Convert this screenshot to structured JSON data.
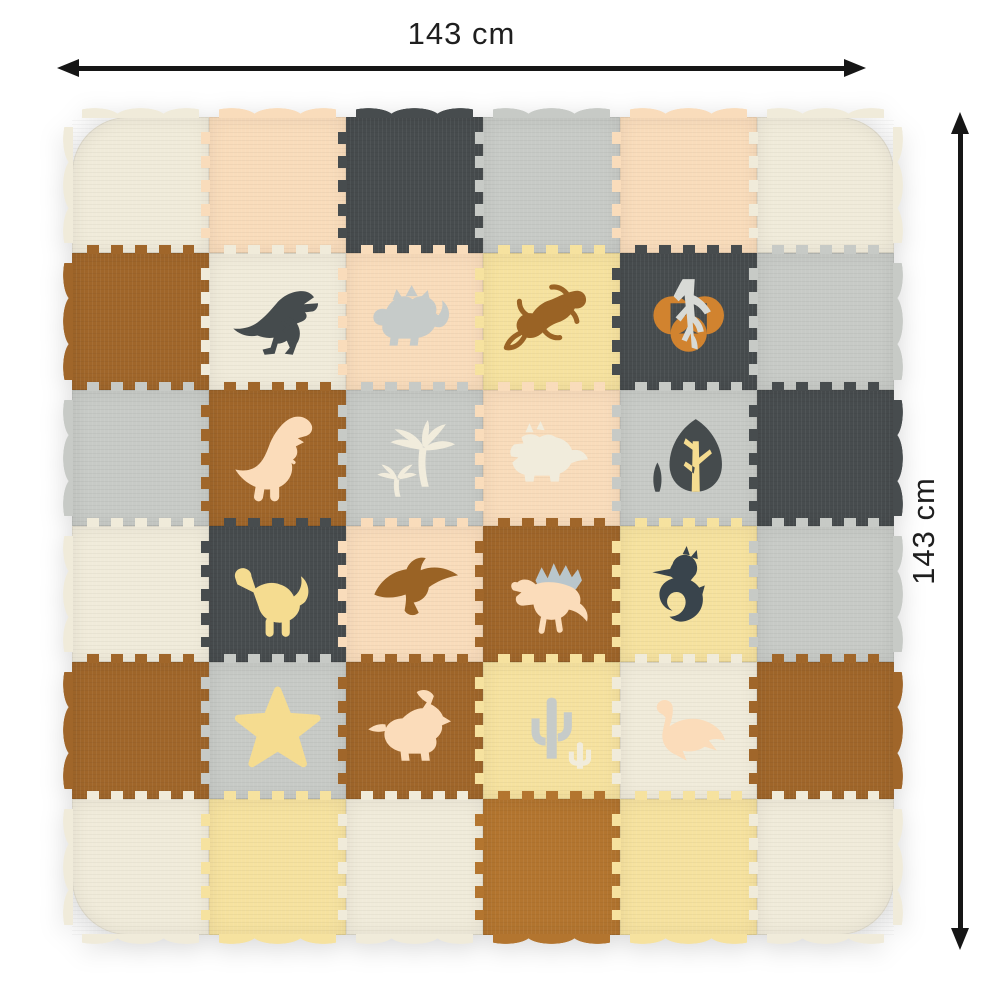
{
  "dimensions": {
    "width_label": "143 cm",
    "height_label": "143 cm",
    "arrow_color": "#161616",
    "label_color": "#1f1f1f"
  },
  "mat": {
    "rows": 6,
    "cols": 6,
    "palette": {
      "cream": "#f0ebda",
      "peach": "#f9dcbb",
      "dark": "#474c4e",
      "gray": "#c7cac6",
      "brown": "#a0662a",
      "caramel": "#b3752f",
      "yellow": "#f6e29f",
      "m_dark": "#454b4d",
      "m_gray": "#c6cbc9",
      "m_cream": "#f1ecdc",
      "m_peach": "#fbdcba",
      "m_yellow": "#f5dc90",
      "m_brown": "#9a6325",
      "orange": "#d1832f",
      "root_gray": "#d8dad6",
      "navy": "#39444c",
      "sail": "#b9c6cc"
    },
    "tiles": [
      {
        "r": 0,
        "c": 0,
        "bg": "cream"
      },
      {
        "r": 0,
        "c": 1,
        "bg": "peach"
      },
      {
        "r": 0,
        "c": 2,
        "bg": "dark"
      },
      {
        "r": 0,
        "c": 3,
        "bg": "gray"
      },
      {
        "r": 0,
        "c": 4,
        "bg": "peach"
      },
      {
        "r": 0,
        "c": 5,
        "bg": "cream"
      },
      {
        "r": 1,
        "c": 0,
        "bg": "brown"
      },
      {
        "r": 1,
        "c": 1,
        "bg": "cream",
        "motif": "trex",
        "colors": [
          "m_dark"
        ]
      },
      {
        "r": 1,
        "c": 2,
        "bg": "peach",
        "motif": "stegosaurus",
        "colors": [
          "m_gray"
        ]
      },
      {
        "r": 1,
        "c": 3,
        "bg": "yellow",
        "motif": "gecko",
        "colors": [
          "m_brown"
        ]
      },
      {
        "r": 1,
        "c": 4,
        "bg": "dark",
        "motif": "tree_roots",
        "colors": [
          "orange",
          "root_gray"
        ]
      },
      {
        "r": 1,
        "c": 5,
        "bg": "gray"
      },
      {
        "r": 2,
        "c": 0,
        "bg": "gray"
      },
      {
        "r": 2,
        "c": 1,
        "bg": "brown",
        "motif": "trex_big",
        "colors": [
          "m_peach"
        ]
      },
      {
        "r": 2,
        "c": 2,
        "bg": "gray",
        "motif": "palms",
        "colors": [
          "m_cream"
        ]
      },
      {
        "r": 2,
        "c": 3,
        "bg": "peach",
        "motif": "triceratops",
        "colors": [
          "m_cream"
        ]
      },
      {
        "r": 2,
        "c": 4,
        "bg": "gray",
        "motif": "tree",
        "colors": [
          "m_dark",
          "m_yellow",
          "m_dark"
        ]
      },
      {
        "r": 2,
        "c": 5,
        "bg": "dark"
      },
      {
        "r": 3,
        "c": 0,
        "bg": "cream"
      },
      {
        "r": 3,
        "c": 1,
        "bg": "dark",
        "motif": "brachiosaurus",
        "colors": [
          "m_yellow"
        ]
      },
      {
        "r": 3,
        "c": 2,
        "bg": "peach",
        "motif": "pterodactyl",
        "colors": [
          "m_brown"
        ]
      },
      {
        "r": 3,
        "c": 3,
        "bg": "brown",
        "motif": "spinosaurus",
        "colors": [
          "sail",
          "m_peach"
        ]
      },
      {
        "r": 3,
        "c": 4,
        "bg": "yellow",
        "motif": "seahorse",
        "colors": [
          "navy"
        ]
      },
      {
        "r": 3,
        "c": 5,
        "bg": "gray"
      },
      {
        "r": 4,
        "c": 0,
        "bg": "brown"
      },
      {
        "r": 4,
        "c": 1,
        "bg": "gray",
        "motif": "star",
        "colors": [
          "m_yellow"
        ]
      },
      {
        "r": 4,
        "c": 2,
        "bg": "brown",
        "motif": "parasaurolophus",
        "colors": [
          "m_peach"
        ]
      },
      {
        "r": 4,
        "c": 3,
        "bg": "yellow",
        "motif": "cactus",
        "colors": [
          "m_gray",
          "m_cream"
        ]
      },
      {
        "r": 4,
        "c": 4,
        "bg": "cream",
        "motif": "plesiosaur",
        "colors": [
          "m_peach"
        ]
      },
      {
        "r": 4,
        "c": 5,
        "bg": "brown"
      },
      {
        "r": 5,
        "c": 0,
        "bg": "cream"
      },
      {
        "r": 5,
        "c": 1,
        "bg": "yellow"
      },
      {
        "r": 5,
        "c": 2,
        "bg": "cream"
      },
      {
        "r": 5,
        "c": 3,
        "bg": "caramel"
      },
      {
        "r": 5,
        "c": 4,
        "bg": "yellow"
      },
      {
        "r": 5,
        "c": 5,
        "bg": "cream"
      }
    ]
  }
}
